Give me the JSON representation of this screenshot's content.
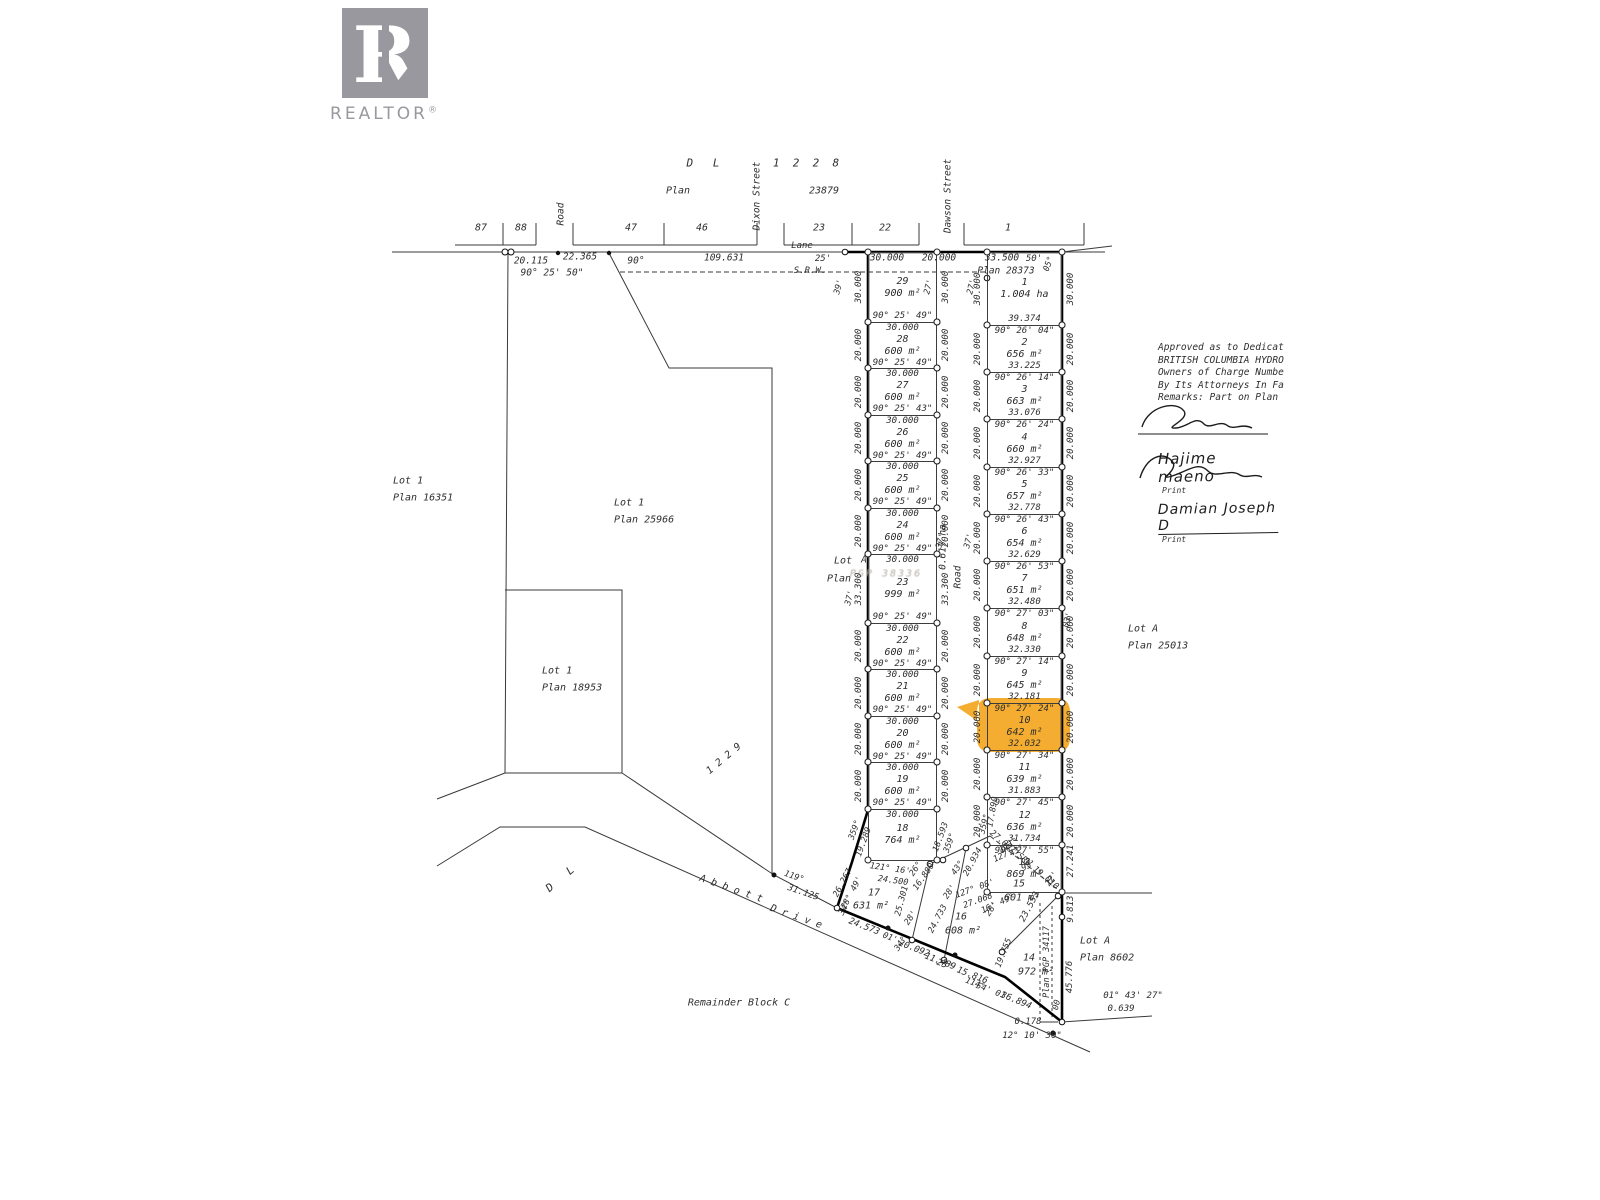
{
  "branding": {
    "logo_initial": "R",
    "logo_text": "REALTOR",
    "registered": "®"
  },
  "highlight": {
    "color": "#F3A41A",
    "lot": "10"
  },
  "approval": {
    "lines": [
      "Approved as to Dedicat",
      "BRITISH COLUMBIA HYDRO",
      "Owners of Charge Numbe",
      "By Its Attorneys In Fa",
      "Remarks: Part on Plan"
    ],
    "signatures": [
      {
        "name": "Hajime maeno",
        "caption": "Print"
      },
      {
        "name": "Damian Joseph D",
        "caption": "Print"
      }
    ]
  },
  "map": {
    "left_column": {
      "x": 868,
      "w": 69,
      "top": 252,
      "cells": [
        {
          "id": "29",
          "h": 70,
          "area": "900 m²",
          "bottom": "90° 25' 49\"",
          "side": "30.000"
        },
        {
          "id": "28",
          "h": 46,
          "top": "30.000",
          "area": "600 m²",
          "bottom": "90° 25' 49\"",
          "side": "20.000"
        },
        {
          "id": "27",
          "h": 47,
          "top": "30.000",
          "area": "600 m²",
          "bottom": "90° 25' 43\"",
          "side": "20.000"
        },
        {
          "id": "26",
          "h": 46,
          "top": "30.000",
          "area": "600 m²",
          "bottom": "90° 25' 49\"",
          "side": "20.000"
        },
        {
          "id": "25",
          "h": 47,
          "top": "30.000",
          "area": "600 m²",
          "bottom": "90° 25' 49\"",
          "side": "20.000"
        },
        {
          "id": "24",
          "h": 46,
          "top": "30.000",
          "area": "600 m²",
          "bottom": "90° 25' 49\"",
          "side": "20.000"
        },
        {
          "id": "23",
          "h": 69,
          "top": "30.000",
          "area": "999 m²",
          "bottom": "90° 25' 49\"",
          "side": "33.300"
        },
        {
          "id": "22",
          "h": 46,
          "top": "30.000",
          "area": "600 m²",
          "bottom": "90° 25' 49\"",
          "side": "20.000"
        },
        {
          "id": "21",
          "h": 47,
          "top": "30.000",
          "area": "600 m²",
          "bottom": "90° 25' 49\"",
          "side": "20.000"
        },
        {
          "id": "20",
          "h": 46,
          "top": "30.000",
          "area": "600 m²",
          "bottom": "90° 25' 49\"",
          "side": "20.000"
        },
        {
          "id": "19",
          "h": 47,
          "top": "30.000",
          "area": "600 m²",
          "bottom": "90° 25' 49\"",
          "side": "20.000"
        },
        {
          "id": "18",
          "h": 51,
          "top": "30.000",
          "area": "764 m²",
          "side": null
        }
      ]
    },
    "right_column": {
      "x": 987,
      "w": 75,
      "top": 252,
      "cells": [
        {
          "id": "1",
          "h": 73,
          "area": "1.004 ha",
          "bottom": "39.374",
          "side": "30.000"
        },
        {
          "id": "2",
          "h": 47,
          "top": "90° 26' 04\"",
          "area": "656 m²",
          "bottom": "33.225",
          "side": "20.000"
        },
        {
          "id": "3",
          "h": 47,
          "top": "90° 26' 14\"",
          "area": "663 m²",
          "bottom": "33.076",
          "side": "20.000"
        },
        {
          "id": "4",
          "h": 48,
          "top": "90° 26' 24\"",
          "area": "660 m²",
          "bottom": "32.927",
          "side": "20.000"
        },
        {
          "id": "5",
          "h": 47,
          "top": "90° 26' 33\"",
          "area": "657 m²",
          "bottom": "32.778",
          "side": "20.000"
        },
        {
          "id": "6",
          "h": 47,
          "top": "90° 26' 43\"",
          "area": "654 m²",
          "bottom": "32.629",
          "side": "20.000"
        },
        {
          "id": "7",
          "h": 47,
          "top": "90° 26' 53\"",
          "area": "651 m²",
          "bottom": "32.480",
          "side": "20.000"
        },
        {
          "id": "8",
          "h": 48,
          "top": "90° 27' 03\"",
          "area": "648 m²",
          "bottom": "32.330",
          "side": "20.000"
        },
        {
          "id": "9",
          "h": 47,
          "top": "90° 27' 14\"",
          "area": "645 m²",
          "bottom": "32.181",
          "side": "20.000"
        },
        {
          "id": "10",
          "h": 47,
          "top": "90° 27' 24\"",
          "area": "642 m²",
          "bottom": "32.032",
          "side": "20.000",
          "highlight": true
        },
        {
          "id": "11",
          "h": 47,
          "top": "90° 27' 34\"",
          "area": "639 m²",
          "bottom": "31.883",
          "side": "20.000"
        },
        {
          "id": "12",
          "h": 48,
          "top": "90° 27' 45\"",
          "area": "636 m²",
          "bottom": "31.734",
          "side": "20.000"
        },
        {
          "id": "13",
          "h": 47,
          "top": "90° 27' 55\"",
          "area": "869 m²",
          "side": null
        }
      ]
    },
    "annotations": [
      {
        "t": "D   L",
        "x": 703,
        "y": 163,
        "s": 11
      },
      {
        "t": "1  2  2  8",
        "x": 806,
        "y": 163,
        "s": 11
      },
      {
        "t": "Plan",
        "x": 678,
        "y": 191
      },
      {
        "t": "23879",
        "x": 824,
        "y": 191
      },
      {
        "t": "Dixon Street",
        "x": 757,
        "y": 196,
        "r": -90,
        "s": 9.5
      },
      {
        "t": "Dawson Street",
        "x": 948,
        "y": 196,
        "r": -90,
        "s": 9.5
      },
      {
        "t": "Road",
        "x": 561,
        "y": 214,
        "r": -90,
        "s": 9.5
      },
      {
        "t": "87",
        "x": 481,
        "y": 228
      },
      {
        "t": "88",
        "x": 521,
        "y": 228
      },
      {
        "t": "47",
        "x": 631,
        "y": 228
      },
      {
        "t": "46",
        "x": 702,
        "y": 228
      },
      {
        "t": "23",
        "x": 819,
        "y": 228
      },
      {
        "t": "22",
        "x": 885,
        "y": 228
      },
      {
        "t": "1",
        "x": 1008,
        "y": 228
      },
      {
        "t": "Lane",
        "x": 802,
        "y": 246,
        "s": 9
      },
      {
        "t": "20.115",
        "x": 531,
        "y": 261,
        "s": 9.5
      },
      {
        "t": "22.365",
        "x": 580,
        "y": 257,
        "s": 9.5
      },
      {
        "t": "90° 25' 50\"",
        "x": 552,
        "y": 273,
        "s": 9.5
      },
      {
        "t": "90°",
        "x": 636,
        "y": 261,
        "s": 9.5
      },
      {
        "t": "109.631",
        "x": 724,
        "y": 258,
        "s": 9.5
      },
      {
        "t": "25'",
        "x": 823,
        "y": 259,
        "s": 9
      },
      {
        "t": "S.R.W.",
        "x": 810,
        "y": 271,
        "s": 9
      },
      {
        "t": "30.000",
        "x": 887,
        "y": 258,
        "s": 9.5
      },
      {
        "t": "20.000",
        "x": 939,
        "y": 258,
        "s": 9.5
      },
      {
        "t": "33.500",
        "x": 1002,
        "y": 258,
        "s": 9.5
      },
      {
        "t": "50'",
        "x": 1034,
        "y": 259,
        "s": 9
      },
      {
        "t": "Plan 28373",
        "x": 1006,
        "y": 271,
        "s": 9.5
      },
      {
        "t": "05°",
        "x": 1049,
        "y": 264,
        "r": -70,
        "s": 8.5
      },
      {
        "t": "39'",
        "x": 839,
        "y": 287,
        "r": -75,
        "s": 8.5
      },
      {
        "t": "27'",
        "x": 929,
        "y": 287,
        "r": -75,
        "s": 8.5
      },
      {
        "t": "27'",
        "x": 972,
        "y": 287,
        "r": -75,
        "s": 8.5
      },
      {
        "t": "37'",
        "x": 850,
        "y": 598,
        "r": -75,
        "s": 8.5
      },
      {
        "t": "37'",
        "x": 941,
        "y": 541,
        "r": -75,
        "s": 8.5
      },
      {
        "t": "37'",
        "x": 969,
        "y": 541,
        "r": -75,
        "s": 8.5
      },
      {
        "t": "03'",
        "x": 1068,
        "y": 620,
        "r": -75,
        "s": 8.5
      },
      {
        "t": "Road",
        "x": 958,
        "y": 577,
        "r": -90,
        "s": 9.5
      },
      {
        "t": "0.617 ha",
        "x": 943,
        "y": 547,
        "r": -90,
        "s": 9.5
      },
      {
        "t": "Lot",
        "x": 843,
        "y": 561
      },
      {
        "t": "Plan",
        "x": 839,
        "y": 579
      },
      {
        "t": "A",
        "x": 864,
        "y": 560,
        "s": 9.5
      },
      {
        "t": "PGP 38336",
        "x": 886,
        "y": 574,
        "c": "stamp"
      },
      {
        "t": "Lot 1",
        "x": 393,
        "y": 481,
        "a": "l"
      },
      {
        "t": "Plan 16351",
        "x": 393,
        "y": 498,
        "a": "l"
      },
      {
        "t": "Lot 1",
        "x": 614,
        "y": 503,
        "a": "l"
      },
      {
        "t": "Plan 25966",
        "x": 614,
        "y": 520,
        "a": "l"
      },
      {
        "t": "Lot 1",
        "x": 542,
        "y": 671,
        "a": "l"
      },
      {
        "t": "Plan 18953",
        "x": 542,
        "y": 688,
        "a": "l"
      },
      {
        "t": "Lot A",
        "x": 1128,
        "y": 629,
        "a": "l"
      },
      {
        "t": "Plan 25013",
        "x": 1128,
        "y": 646,
        "a": "l"
      },
      {
        "t": "Lot A",
        "x": 1080,
        "y": 941,
        "a": "l"
      },
      {
        "t": "Plan 8602",
        "x": 1080,
        "y": 958,
        "a": "l"
      },
      {
        "t": "1 2 2 9",
        "x": 724,
        "y": 759,
        "r": -40,
        "s": 10
      },
      {
        "t": "D   L",
        "x": 560,
        "y": 879,
        "r": -40,
        "s": 11
      },
      {
        "t": "A b b o t t",
        "x": 731,
        "y": 889,
        "r": 19,
        "s": 10
      },
      {
        "t": "D r i v e",
        "x": 796,
        "y": 917,
        "r": 19,
        "s": 10
      },
      {
        "t": "119°",
        "x": 794,
        "y": 877,
        "r": 19,
        "s": 8.5
      },
      {
        "t": "31.125",
        "x": 803,
        "y": 893,
        "r": 19,
        "s": 9
      },
      {
        "t": "Remainder Block C",
        "x": 739,
        "y": 1003
      },
      {
        "t": "27.241",
        "x": 1071,
        "y": 861,
        "r": -90,
        "s": 9
      },
      {
        "t": "9.813",
        "x": 1071,
        "y": 909,
        "r": -90,
        "s": 9
      },
      {
        "t": "45.776",
        "x": 1070,
        "y": 977,
        "r": -90,
        "s": 9
      },
      {
        "t": "Plan PGP 34117",
        "x": 1047,
        "y": 962,
        "r": -90,
        "s": 8.5
      },
      {
        "t": "00",
        "x": 1057,
        "y": 1005,
        "r": -75,
        "s": 8.5
      },
      {
        "t": "01° 43' 27\"",
        "x": 1133,
        "y": 996,
        "s": 9
      },
      {
        "t": "0.639",
        "x": 1121,
        "y": 1009,
        "s": 9
      },
      {
        "t": "0.178",
        "x": 1028,
        "y": 1022,
        "s": 9
      },
      {
        "t": "12° 10' 30\"",
        "x": 1032,
        "y": 1036,
        "s": 9
      },
      {
        "t": "27.067 SRW 19.010",
        "x": 1024,
        "y": 860,
        "r": 40,
        "s": 8.5
      },
      {
        "t": "17.890",
        "x": 993,
        "y": 812,
        "r": -80,
        "s": 8.5
      },
      {
        "t": "359°",
        "x": 985,
        "y": 824,
        "r": -75,
        "s": 8.5
      },
      {
        "t": "359°",
        "x": 855,
        "y": 830,
        "r": -70,
        "s": 8.5
      },
      {
        "t": "19.289",
        "x": 864,
        "y": 842,
        "r": -70,
        "s": 8.5
      },
      {
        "t": "18.593",
        "x": 941,
        "y": 837,
        "r": -70,
        "s": 8.5
      },
      {
        "t": "359°",
        "x": 950,
        "y": 843,
        "r": -70,
        "s": 8.5
      },
      {
        "t": "43°",
        "x": 958,
        "y": 868,
        "r": -55,
        "s": 8.5
      },
      {
        "t": "121° 16'",
        "x": 890,
        "y": 869,
        "r": 8,
        "s": 8.5
      },
      {
        "t": "24.500",
        "x": 893,
        "y": 881,
        "r": 8,
        "s": 8.5
      },
      {
        "t": "26°",
        "x": 916,
        "y": 869,
        "r": -55,
        "s": 8.5
      },
      {
        "t": "16.880",
        "x": 924,
        "y": 877,
        "r": -55,
        "s": 8.5
      },
      {
        "t": "17",
        "x": 874,
        "y": 893
      },
      {
        "t": "631 m²",
        "x": 871,
        "y": 906
      },
      {
        "t": "25.301",
        "x": 902,
        "y": 901,
        "r": -75,
        "s": 8.5
      },
      {
        "t": "28'",
        "x": 911,
        "y": 918,
        "r": -55,
        "s": 8.5
      },
      {
        "t": "26.267",
        "x": 843,
        "y": 883,
        "r": -62,
        "s": 8.5
      },
      {
        "t": "28° 49'",
        "x": 852,
        "y": 893,
        "r": -62,
        "s": 8.5
      },
      {
        "t": "34°",
        "x": 845,
        "y": 908,
        "r": -62,
        "s": 8.5
      },
      {
        "t": "24.573",
        "x": 864,
        "y": 927,
        "r": 21,
        "s": 9
      },
      {
        "t": "01'",
        "x": 890,
        "y": 938,
        "r": 21,
        "s": 8.5
      },
      {
        "t": "34°",
        "x": 901,
        "y": 944,
        "r": -55,
        "s": 8.5
      },
      {
        "t": "20.092",
        "x": 914,
        "y": 949,
        "r": 21,
        "s": 9
      },
      {
        "t": "11.489",
        "x": 940,
        "y": 962,
        "r": 21,
        "s": 9
      },
      {
        "t": "24.733",
        "x": 938,
        "y": 919,
        "r": -62,
        "s": 8.5
      },
      {
        "t": "16",
        "x": 961,
        "y": 917
      },
      {
        "t": "608 m²",
        "x": 963,
        "y": 931
      },
      {
        "t": "127° 08'",
        "x": 975,
        "y": 889,
        "r": -20,
        "s": 8.5
      },
      {
        "t": "27.068",
        "x": 978,
        "y": 901,
        "r": -20,
        "s": 8.5
      },
      {
        "t": "16' 49°",
        "x": 998,
        "y": 904,
        "r": -25,
        "s": 8.5
      },
      {
        "t": "28'",
        "x": 950,
        "y": 892,
        "r": -55,
        "s": 8.5
      },
      {
        "t": "20.934",
        "x": 973,
        "y": 862,
        "r": -62,
        "s": 8.5
      },
      {
        "t": "15",
        "x": 1019,
        "y": 884
      },
      {
        "t": "601 m²",
        "x": 1022,
        "y": 898
      },
      {
        "t": "127°",
        "x": 1003,
        "y": 856,
        "r": -25,
        "s": 8.5
      },
      {
        "t": "95'",
        "x": 1029,
        "y": 866,
        "r": -25,
        "s": 8.5
      },
      {
        "t": "22'",
        "x": 1052,
        "y": 879,
        "r": -55,
        "s": 8.5
      },
      {
        "t": "43°",
        "x": 1017,
        "y": 851,
        "r": -30,
        "s": 8.5
      },
      {
        "t": "121°",
        "x": 1009,
        "y": 846,
        "r": -30,
        "s": 8.5
      },
      {
        "t": "23.553",
        "x": 1030,
        "y": 907,
        "r": -62,
        "s": 9
      },
      {
        "t": "19.755",
        "x": 1004,
        "y": 953,
        "r": -68,
        "s": 8.5
      },
      {
        "t": "28'",
        "x": 992,
        "y": 909,
        "r": -55,
        "s": 8.5
      },
      {
        "t": "23° 15.816",
        "x": 962,
        "y": 972,
        "r": 21,
        "s": 9
      },
      {
        "t": "114°",
        "x": 975,
        "y": 984,
        "r": 21,
        "s": 8.5
      },
      {
        "t": "54' 01'",
        "x": 993,
        "y": 992,
        "r": 21,
        "s": 8.5
      },
      {
        "t": "14",
        "x": 1029,
        "y": 958
      },
      {
        "t": "972 m²",
        "x": 1036,
        "y": 972
      },
      {
        "t": "36.894",
        "x": 1016,
        "y": 1001,
        "r": 22,
        "s": 9
      }
    ]
  }
}
